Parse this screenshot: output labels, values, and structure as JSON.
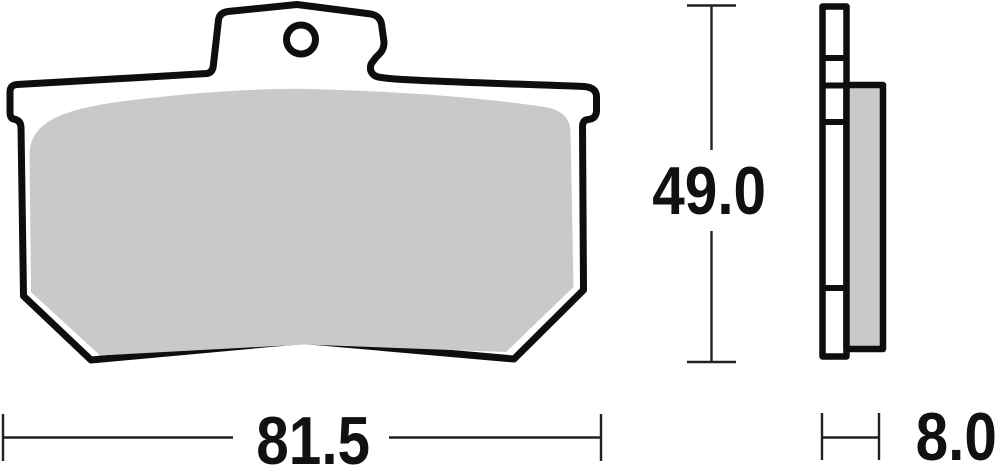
{
  "dimensions": {
    "height_label": "49.0",
    "width_label": "81.5",
    "thickness_label": "8.0"
  },
  "colors": {
    "outline": "#0e0e0e",
    "plate_fill": "#ffffff",
    "friction_fill": "#c9c9c9",
    "dimension_line": "#222222",
    "hole_fill": "#ffffff"
  }
}
